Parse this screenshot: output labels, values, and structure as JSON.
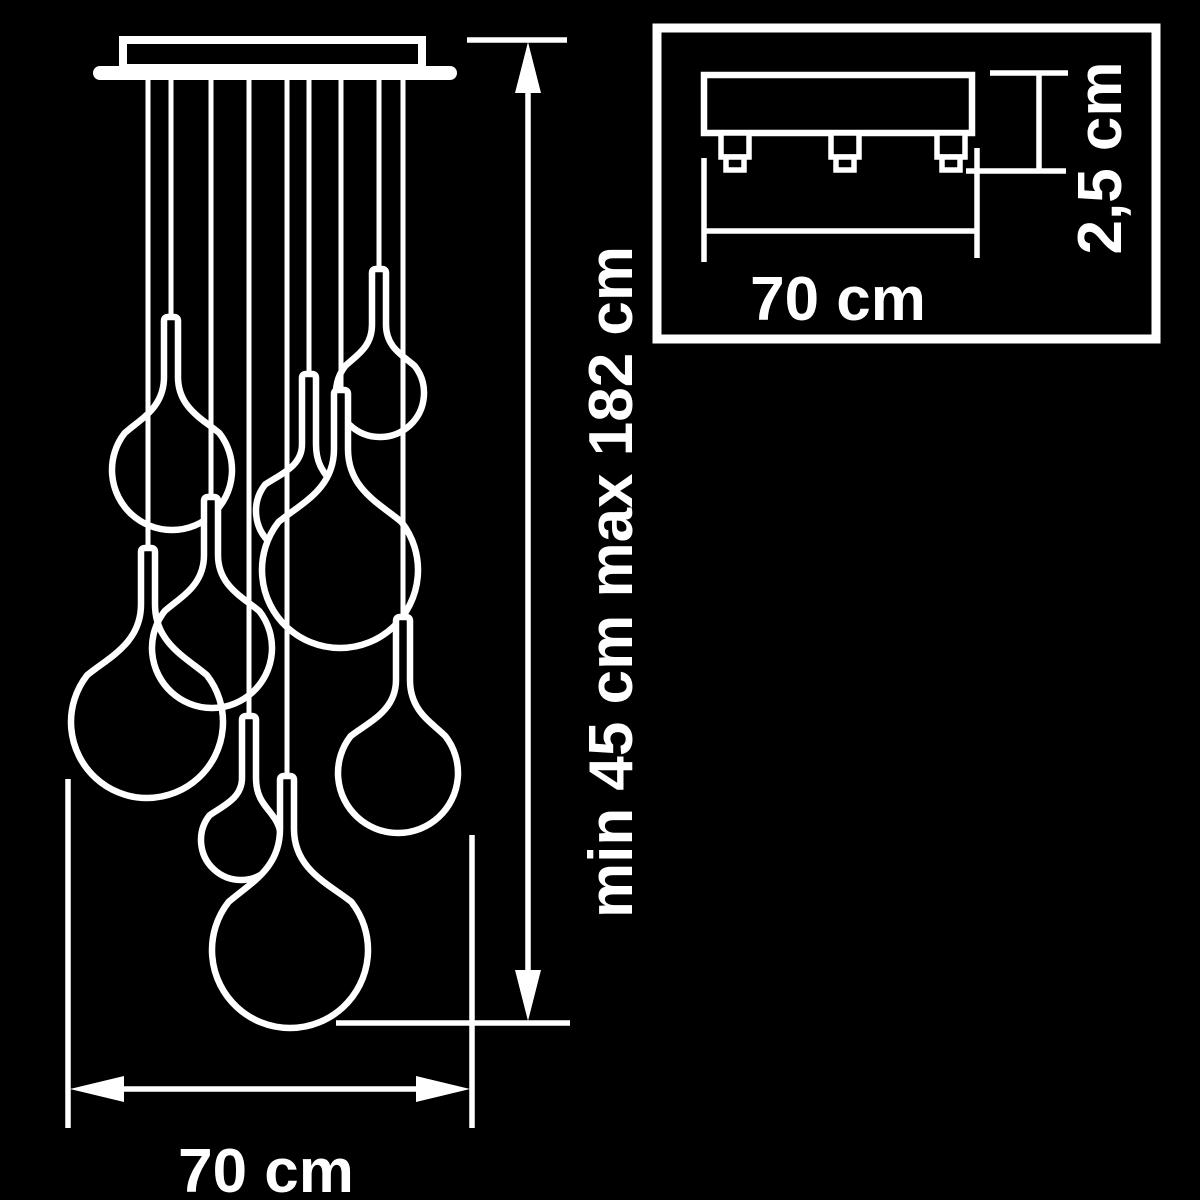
{
  "diagram": {
    "type": "pendant-chandelier-dimension-drawing",
    "colors": {
      "background": "#000000",
      "line": "#ffffff"
    },
    "main_view": {
      "height_label": "min 45 cm max 182 cm",
      "width_label": "70 cm",
      "pendant_count": 9,
      "canopy": {
        "box": [
          123,
          40,
          299,
          28
        ],
        "plate": [
          93,
          66,
          364,
          14
        ]
      },
      "cord_top_y": 76,
      "pendants": [
        {
          "id": "pendant-top-right",
          "x": 379,
          "cap": 269,
          "cx": 380,
          "cy": 393,
          "r": 44,
          "filled": true
        },
        {
          "id": "pendant-mid-small",
          "x": 309,
          "cap": 374,
          "cx": 299,
          "cy": 511,
          "r": 43,
          "filled": true
        },
        {
          "id": "pendant-upper-left",
          "x": 171,
          "cap": 317,
          "cx": 172,
          "cy": 470,
          "r": 60,
          "filled": true
        },
        {
          "id": "pendant-mid-left",
          "x": 211,
          "cap": 497,
          "cx": 212,
          "cy": 648,
          "r": 60,
          "filled": true
        },
        {
          "id": "pendant-big-left",
          "x": 148,
          "cap": 548,
          "cx": 147,
          "cy": 722,
          "r": 76,
          "filled": false
        },
        {
          "id": "pendant-mid-large",
          "x": 341,
          "cap": 390,
          "cx": 340,
          "cy": 570,
          "r": 78,
          "filled": true
        },
        {
          "id": "pendant-right",
          "x": 403,
          "cap": 617,
          "cx": 398,
          "cy": 773,
          "r": 60,
          "filled": true
        },
        {
          "id": "pendant-small-bottom",
          "x": 249,
          "cap": 716,
          "cx": 241,
          "cy": 840,
          "r": 40,
          "filled": true
        },
        {
          "id": "pendant-big-bottom",
          "x": 287,
          "cap": 776,
          "cx": 290,
          "cy": 950,
          "r": 78,
          "filled": true
        }
      ]
    },
    "inset_view": {
      "width_label": "70 cm",
      "height_label": "2,5 cm",
      "clip_count": 3,
      "clip_centers": [
        735,
        845,
        951
      ]
    }
  }
}
